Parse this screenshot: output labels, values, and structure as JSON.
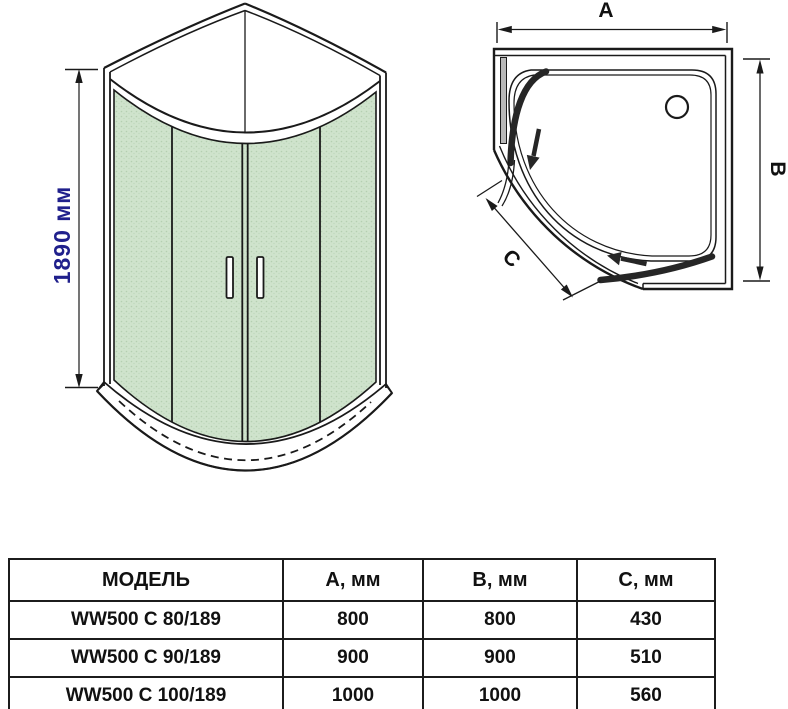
{
  "front_view": {
    "height_dim": "1890 мм"
  },
  "top_view": {
    "dim_a": "A",
    "dim_b": "B",
    "dim_c": "C"
  },
  "colors": {
    "glass_green": "#cfe3cc",
    "line": "#1a1a1a",
    "dim_text_blue": "#20208c"
  },
  "table": {
    "headers": [
      "МОДЕЛЬ",
      "А, мм",
      "В, мм",
      "С, мм"
    ],
    "rows": [
      {
        "model": "WW500 C 80/189",
        "a": "800",
        "b": "800",
        "c": "430"
      },
      {
        "model": "WW500 C 90/189",
        "a": "900",
        "b": "900",
        "c": "510"
      },
      {
        "model": "WW500 C 100/189",
        "a": "1000",
        "b": "1000",
        "c": "560"
      }
    ]
  }
}
